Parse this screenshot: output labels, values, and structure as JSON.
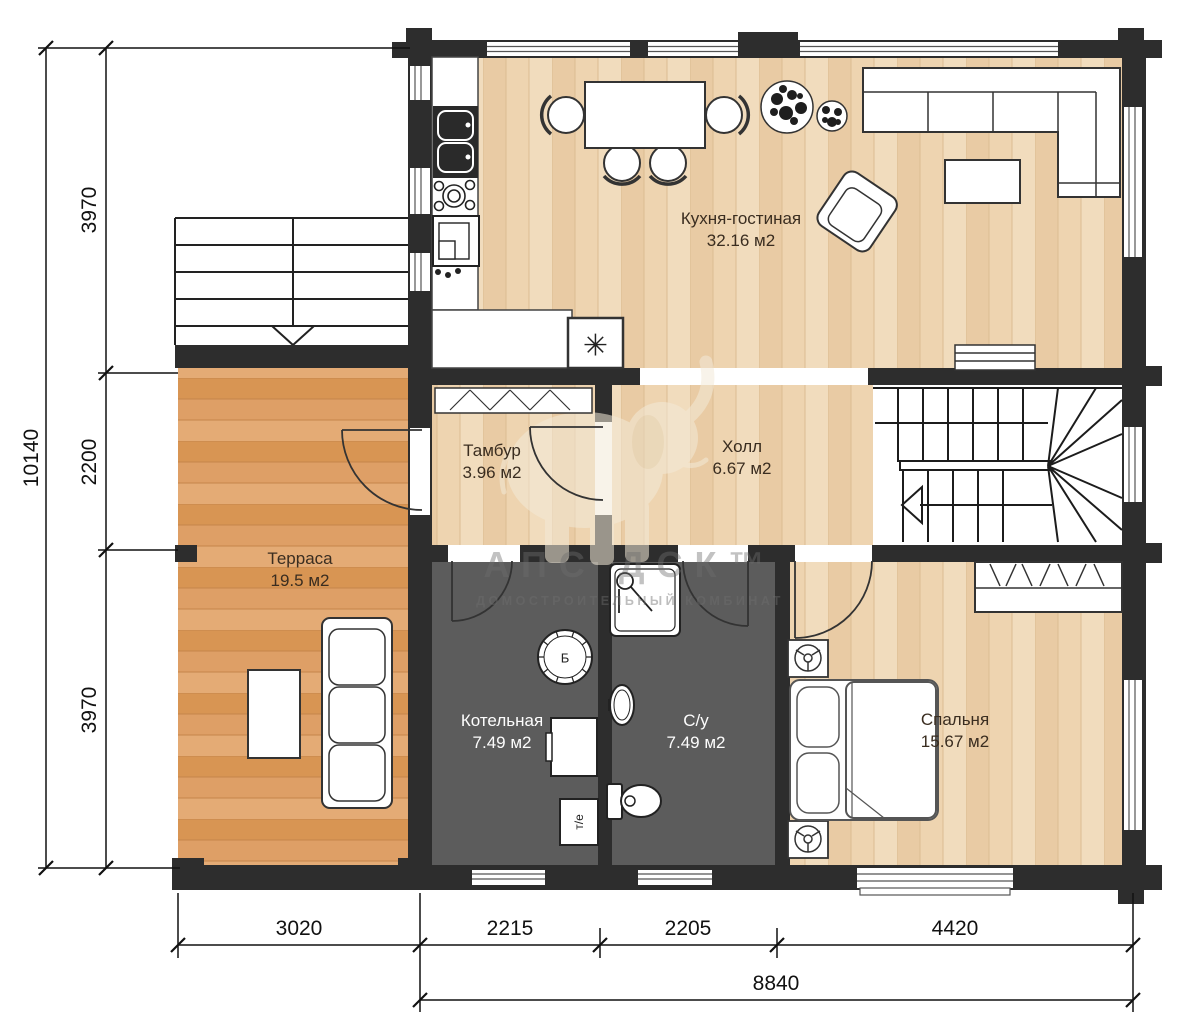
{
  "rooms": [
    {
      "name": "Кухня-гостиная",
      "area": "32.16 м2"
    },
    {
      "name": "Тамбур",
      "area": "3.96 м2"
    },
    {
      "name": "Холл",
      "area": "6.67 м2"
    },
    {
      "name": "Терраса",
      "area": "19.5 м2"
    },
    {
      "name": "Котельная",
      "area": "7.49 м2"
    },
    {
      "name": "С/у",
      "area": "7.49 м2"
    },
    {
      "name": "Спальня",
      "area": "15.67 м2"
    }
  ],
  "dimensions": {
    "left_total": "10140",
    "left_segments": [
      "3970",
      "2200",
      "3970"
    ],
    "bottom_segments": [
      "3020",
      "2215",
      "2205",
      "4420"
    ],
    "bottom_total": "8840"
  },
  "marks": {
    "boiler": "Б",
    "heat_unit": "т/е",
    "stove": "✳"
  },
  "watermark": {
    "brand": "АПС ДСК™",
    "subtitle": "ДОМОСТРОИТЕЛЬНЫЙ КОМБИНАТ"
  },
  "colors": {
    "wall": "#2d2d2d",
    "wood_floor": "#eed4b0",
    "terrace_floor": "#de9f66",
    "wet_floor": "#5c5c5c"
  }
}
